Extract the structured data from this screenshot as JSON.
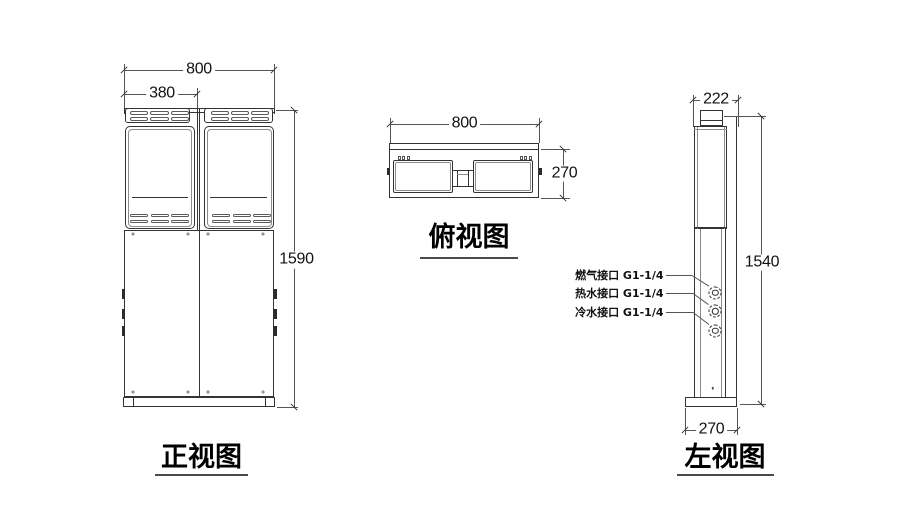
{
  "drawing": {
    "front_view": {
      "title": "正视图",
      "dim_width": "800",
      "dim_panel_width": "380",
      "dim_height": "1590"
    },
    "top_view": {
      "title": "俯视图",
      "dim_width": "800",
      "dim_depth": "270"
    },
    "left_view": {
      "title": "左视图",
      "dim_depth": "222",
      "dim_height": "1540",
      "dim_base_depth": "270",
      "connections": [
        {
          "label": "燃气接口 G1-1/4"
        },
        {
          "label": "热水接口 G1-1/4"
        },
        {
          "label": "冷水接口 G1-1/4"
        }
      ]
    },
    "colors": {
      "object_line": "#333333",
      "dim_line": "#555555",
      "text": "#111111",
      "title_underline": "#4a4a4a",
      "background": "#ffffff"
    }
  }
}
